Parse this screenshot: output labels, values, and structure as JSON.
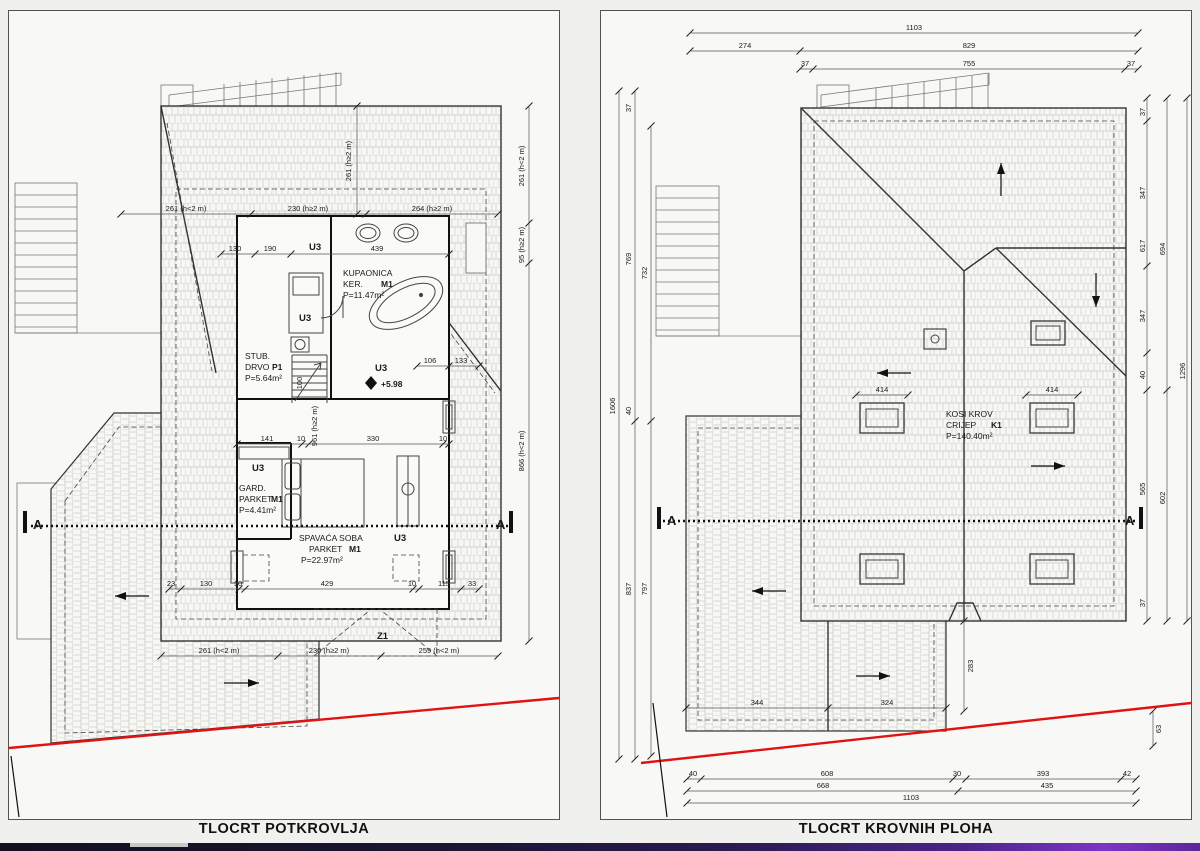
{
  "titles": {
    "left": "TLOCRT POTKROVLJA",
    "right": "TLOCRT KROVNIH PLOHA"
  },
  "left": {
    "section_label": "A",
    "marks": {
      "u3": "U3",
      "z1": "Z1",
      "elev": "+5.98"
    },
    "rooms": {
      "kupaonica": {
        "name": "KUPAONICA",
        "finish": "KER.",
        "mark": "M1",
        "area": "P=11.47m²"
      },
      "stub": {
        "name": "STUB.",
        "finish": "DRVO",
        "mark": "P1",
        "area": "P=5.64m²"
      },
      "gard": {
        "name": "GARD.",
        "finish": "PARKET",
        "mark": "M1",
        "area": "P=4.41m²"
      },
      "spavaca": {
        "name": "SPAVAĆA SOBA",
        "finish": "PARKET",
        "mark": "M1",
        "area": "P=22.97m²"
      }
    },
    "dims": {
      "top": [
        "261 (h<2 m)",
        "230 (h≥2 m)",
        "264 (h≥2 m)"
      ],
      "top_v": "261 (h≥2 m)",
      "right_v": [
        "261 (h<2 m)",
        "95 (h≥2 m)",
        "866 (h<2 m)"
      ],
      "bottom": [
        "261 (h<2 m)",
        "230 (h≥2 m)",
        "259 (h<2 m)"
      ],
      "row1": [
        "130",
        "190",
        "439"
      ],
      "row2": [
        "141",
        "10",
        "330",
        "10"
      ],
      "row3": [
        "23",
        "130",
        "10",
        "429",
        "10",
        "115",
        "33"
      ],
      "mid_v": [
        "100",
        "961 (h≥2 m)"
      ],
      "mid": [
        "106",
        "133"
      ]
    }
  },
  "right": {
    "section_label": "A",
    "roof": {
      "name": "KOSI KROV",
      "finish": "CRIJEP",
      "mark": "K1",
      "area": "P=140.40m²"
    },
    "dims": {
      "top": [
        "1103",
        "274",
        "829",
        "37",
        "755",
        "37"
      ],
      "left_v": [
        "1606",
        "37",
        "769",
        "40",
        "837",
        "732",
        "797"
      ],
      "right_v": [
        "37",
        "347",
        "617",
        "694",
        "347",
        "40",
        "1296",
        "565",
        "602",
        "37"
      ],
      "sky": [
        "414",
        "414"
      ],
      "wing": [
        "344",
        "324"
      ],
      "notch": "283",
      "corner": "63",
      "bottom": [
        "40",
        "608",
        "30",
        "393",
        "42",
        "668",
        "435",
        "1103"
      ]
    }
  }
}
